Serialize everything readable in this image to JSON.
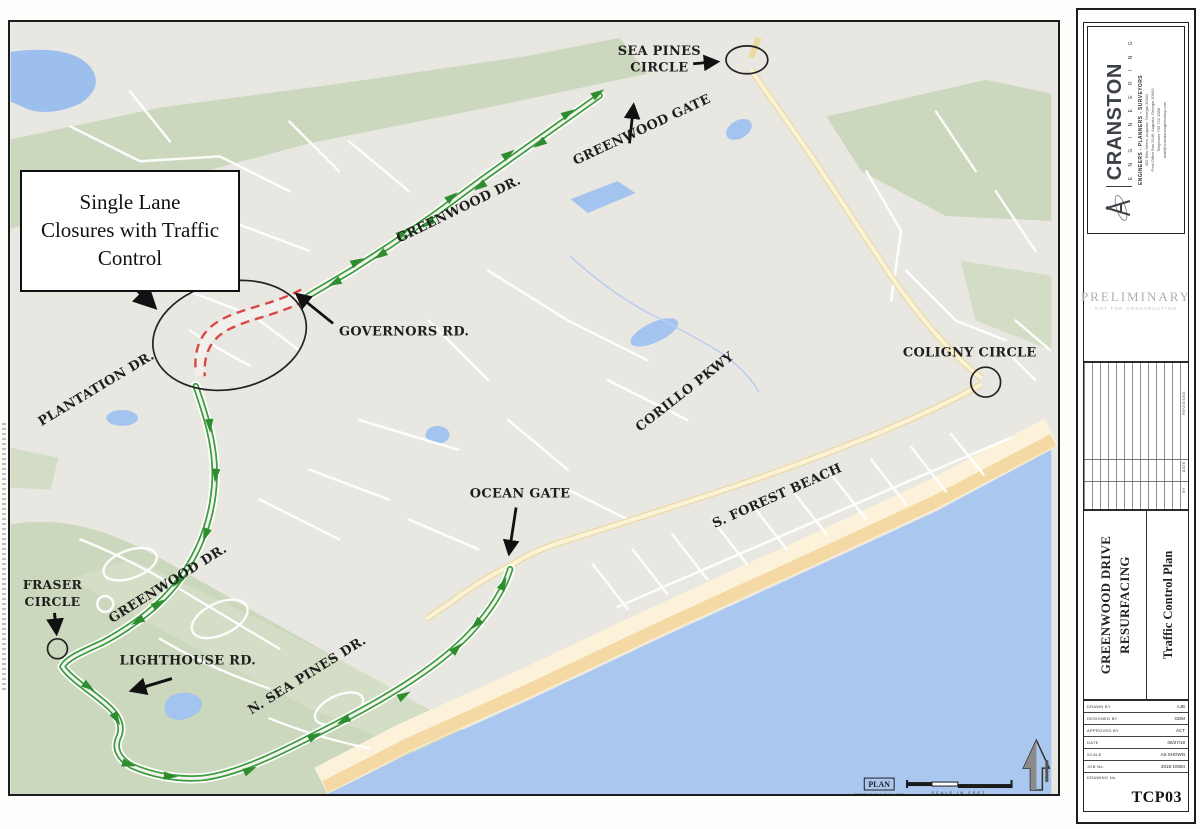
{
  "map": {
    "labels": {
      "sea_pines_1": "SEA PINES",
      "sea_pines_2": "CIRCLE",
      "greenwood_gate": "GREENWOOD GATE",
      "greenwood_dr_upper": "GREENWOOD DR.",
      "governors_rd": "GOVERNORS RD.",
      "plantation_dr": "PLANTATION DR.",
      "coligny_circle": "COLIGNY CIRCLE",
      "corillo_pkwy": "CORILLO PKWY",
      "ocean_gate": "OCEAN GATE",
      "s_forest_beach": "S. FOREST BEACH",
      "fraser_1": "FRASER",
      "fraser_2": "CIRCLE",
      "greenwood_dr_lower": "GREENWOOD DR.",
      "lighthouse_rd": "LIGHTHOUSE RD.",
      "n_sea_pines_dr": "N. SEA PINES DR."
    },
    "callout": {
      "line1": "Single  Lane",
      "line2": "Closures with Traffic",
      "line3": "Control"
    },
    "legend": {
      "plan": "PLAN",
      "plan_note": "GRAPHIC SCALE: 1\" = 300'",
      "scale_units": "SCALE IN FEET"
    },
    "colors": {
      "route_green": "#3d9c3d",
      "closure_red": "#d84744",
      "water_blue": "#a9c7ef",
      "vegetation_green": "#ccd8bd",
      "sand": "#f5dcab",
      "road_yellow": "#f6ecc4"
    }
  },
  "titleblock": {
    "firm": "CRANSTON",
    "firm_sub": "E N G I N E E R I N G",
    "firm_tagline": "ENGINEERS - PLANNERS - SURVEYORS",
    "address1": "452 Ellis Street, Augusta, Georgia 30901",
    "address2": "Post Office Box 2546, Augusta, Georgia 30903",
    "address3": "Telephone 706 722 1588",
    "address4": "mail@cranstonengineering.com",
    "preliminary": "PRELIMINARY",
    "preliminary_sub": "NOT FOR CONSTRUCTION",
    "revision_cols": {
      "col1": "REVISIONS",
      "col2": "DATE",
      "col3": "BY"
    },
    "project_line1": "GREENWOOD DRIVE",
    "project_line2": "RESURFACING",
    "sheet_title": "Traffic Control Plan",
    "fields": {
      "drawn_label": "DRAWN BY",
      "drawn_value": "AJB",
      "designed_label": "DESIGNED BY",
      "designed_value": "GDM",
      "approved_label": "APPROVED BY",
      "approved_value": "ACT",
      "date_label": "DATE",
      "date_value": "06/27/18",
      "scale_label": "SCALE",
      "scale_value": "AS SHOWN",
      "job_label": "JOB No.",
      "job_value": "2018-10084",
      "drawing_label": "DRAWING No.",
      "sheet_number": "TCP03"
    }
  }
}
